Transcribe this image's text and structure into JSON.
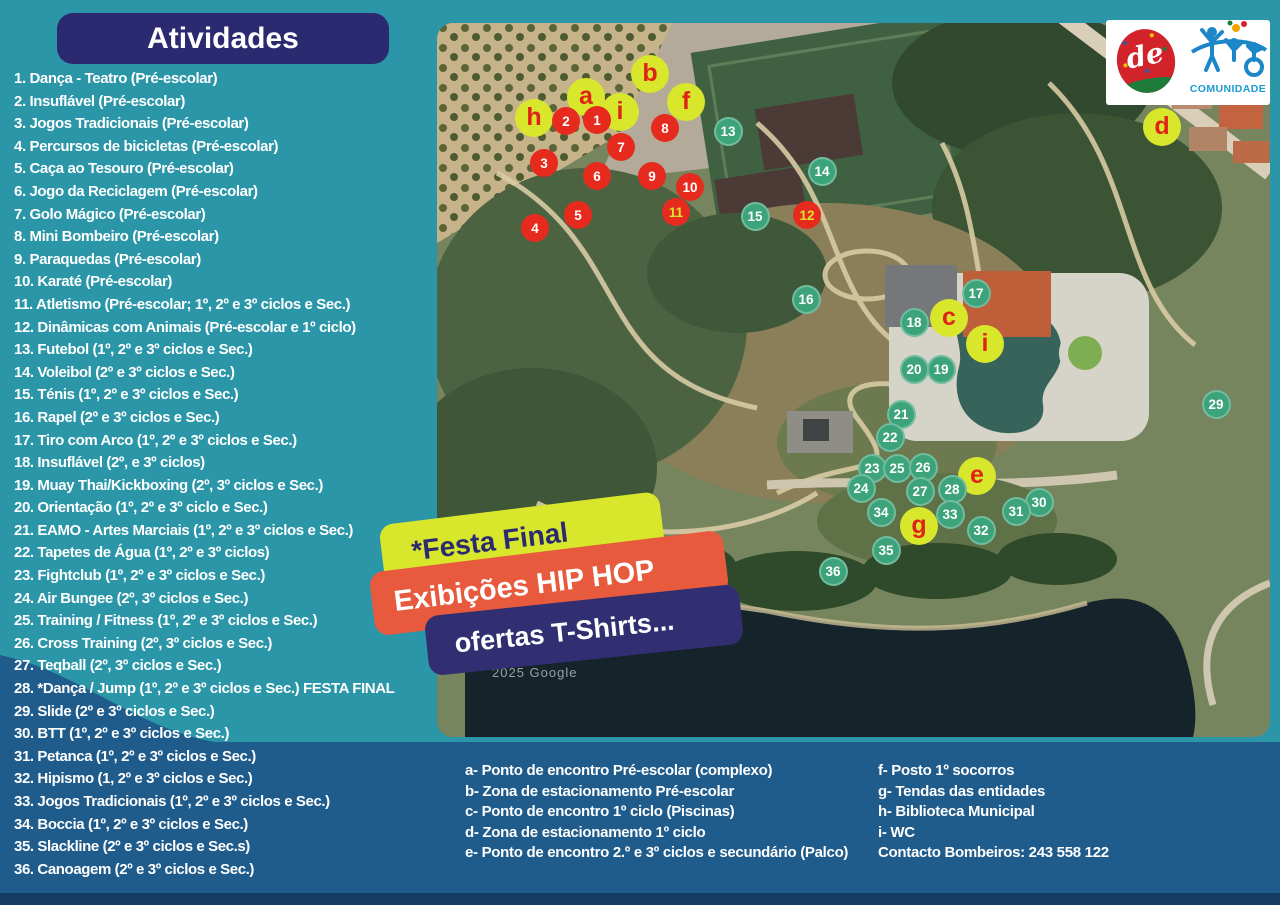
{
  "colors": {
    "bg_teal": "#2a96a8",
    "bg_wave_blue": "#1f5c8c",
    "bottom_bar": "#143c62",
    "header_navy": "#2b2a70",
    "banner_chartreuse": "#d8e72b",
    "banner_orange": "#e75a3e",
    "banner_navy": "#312f72",
    "marker_red": "#e62b1e",
    "marker_teal_green": "#3ca37b",
    "marker_letter_bg": "#d8e72b",
    "marker_letter_text": "#e02317"
  },
  "header": {
    "title": "Atividades"
  },
  "activities": [
    "1. Dança - Teatro (Pré-escolar)",
    "2. Insuflável (Pré-escolar)",
    "3. Jogos Tradicionais (Pré-escolar)",
    "4. Percursos de bicicletas (Pré-escolar)",
    "5. Caça ao Tesouro (Pré-escolar)",
    "6. Jogo da Reciclagem (Pré-escolar)",
    "7. Golo Mágico (Pré-escolar)",
    "8. Mini Bombeiro (Pré-escolar)",
    "9. Paraquedas (Pré-escolar)",
    "10. Karaté (Pré-escolar)",
    "11. Atletismo (Pré-escolar; 1º, 2º e 3º ciclos e Sec.)",
    "12. Dinâmicas com Animais (Pré-escolar e 1º ciclo)",
    "13. Futebol (1º, 2º e 3º ciclos e Sec.)",
    "14. Voleibol (2º e 3º ciclos e Sec.)",
    "15. Ténis (1º, 2º e 3º ciclos e Sec.)",
    "16. Rapel (2º e 3º ciclos e Sec.)",
    "17. Tiro com Arco (1º, 2º e 3º ciclos e Sec.)",
    "18. Insuflável (2º, e 3º ciclos)",
    "19. Muay Thai/Kickboxing (2º, 3º ciclos e Sec.)",
    "20. Orientação (1º, 2º e 3º ciclo e Sec.)",
    "21. EAMO - Artes Marciais (1º, 2º e 3º ciclos e Sec.)",
    "22. Tapetes de Água (1º, 2º e 3º ciclos)",
    "23. Fightclub (1º, 2º e 3º ciclos e Sec.)",
    "24. Air Bungee (2º, 3º ciclos e Sec.)",
    "25. Training / Fitness (1º, 2º e 3º ciclos e Sec.)",
    "26. Cross Training (2º, 3º ciclos e Sec.)",
    "27. Teqball (2º, 3º ciclos e Sec.)",
    "28. *Dança / Jump (1º, 2º e 3º ciclos e Sec.) FESTA FINAL",
    "29. Slide (2º e 3º ciclos e Sec.)",
    "30. BTT (1º, 2º e 3º ciclos e Sec.)",
    "31. Petanca (1º, 2º e 3º ciclos e Sec.)",
    "32. Hipismo  (1, 2º e 3º ciclos e Sec.)",
    "33. Jogos Tradicionais (1º, 2º e 3º ciclos e Sec.)",
    "34. Boccia (1º, 2º e 3º ciclos e Sec.)",
    "35. Slackline (2º e 3º ciclos e Sec.s)",
    "36. Canoagem (2º e 3º ciclos e Sec.)"
  ],
  "banners": {
    "festa": "*Festa Final",
    "hiphop": "Exibições HIP HOP",
    "tshirts": "ofertas T-Shirts..."
  },
  "legend": {
    "left": [
      "a- Ponto de encontro Pré-escolar (complexo)",
      "b- Zona de estacionamento Pré-escolar",
      "c- Ponto de encontro 1º ciclo (Piscinas)",
      "d- Zona de estacionamento 1º ciclo",
      "e- Ponto de encontro 2.º e 3º ciclos e secundário (Palco)"
    ],
    "right": [
      "f- Posto 1º socorros",
      "g- Tendas das entidades",
      "h- Biblioteca Municipal",
      "i- WC"
    ],
    "contact": "Contacto Bombeiros: 243 558 122"
  },
  "map": {
    "watermark": "2025 Google",
    "letter_markers": [
      {
        "label": "h",
        "x": 534,
        "y": 118
      },
      {
        "label": "a",
        "x": 586,
        "y": 97
      },
      {
        "label": "b",
        "x": 650,
        "y": 74
      },
      {
        "label": "i",
        "x": 620,
        "y": 112
      },
      {
        "label": "f",
        "x": 686,
        "y": 102
      },
      {
        "label": "d",
        "x": 1162,
        "y": 127
      },
      {
        "label": "c",
        "x": 949,
        "y": 318
      },
      {
        "label": "i",
        "x": 985,
        "y": 344
      },
      {
        "label": "e",
        "x": 977,
        "y": 476
      },
      {
        "label": "g",
        "x": 919,
        "y": 526
      }
    ],
    "red_markers": [
      {
        "label": "1",
        "x": 597,
        "y": 120
      },
      {
        "label": "2",
        "x": 566,
        "y": 121
      },
      {
        "label": "3",
        "x": 544,
        "y": 163
      },
      {
        "label": "4",
        "x": 535,
        "y": 228
      },
      {
        "label": "5",
        "x": 578,
        "y": 215
      },
      {
        "label": "6",
        "x": 597,
        "y": 176
      },
      {
        "label": "7",
        "x": 621,
        "y": 147
      },
      {
        "label": "8",
        "x": 665,
        "y": 128
      },
      {
        "label": "9",
        "x": 652,
        "y": 176
      },
      {
        "label": "10",
        "x": 690,
        "y": 187
      },
      {
        "label": "11",
        "x": 676,
        "y": 212,
        "yellow_text": true
      },
      {
        "label": "12",
        "x": 807,
        "y": 215,
        "yellow_text": true
      }
    ],
    "teal_markers": [
      {
        "label": "13",
        "x": 728,
        "y": 131
      },
      {
        "label": "14",
        "x": 822,
        "y": 171
      },
      {
        "label": "15",
        "x": 755,
        "y": 216
      },
      {
        "label": "16",
        "x": 806,
        "y": 299
      },
      {
        "label": "17",
        "x": 976,
        "y": 293
      },
      {
        "label": "18",
        "x": 914,
        "y": 322
      },
      {
        "label": "19",
        "x": 941,
        "y": 369
      },
      {
        "label": "20",
        "x": 914,
        "y": 369
      },
      {
        "label": "21",
        "x": 901,
        "y": 414
      },
      {
        "label": "22",
        "x": 890,
        "y": 437
      },
      {
        "label": "23",
        "x": 872,
        "y": 468
      },
      {
        "label": "24",
        "x": 861,
        "y": 488
      },
      {
        "label": "25",
        "x": 897,
        "y": 468
      },
      {
        "label": "26",
        "x": 923,
        "y": 467
      },
      {
        "label": "27",
        "x": 920,
        "y": 491
      },
      {
        "label": "28",
        "x": 952,
        "y": 489
      },
      {
        "label": "29",
        "x": 1216,
        "y": 404
      },
      {
        "label": "30",
        "x": 1039,
        "y": 502
      },
      {
        "label": "31",
        "x": 1016,
        "y": 511
      },
      {
        "label": "32",
        "x": 981,
        "y": 530
      },
      {
        "label": "33",
        "x": 950,
        "y": 514
      },
      {
        "label": "34",
        "x": 881,
        "y": 512
      },
      {
        "label": "35",
        "x": 886,
        "y": 550
      },
      {
        "label": "36",
        "x": 833,
        "y": 571
      }
    ]
  },
  "logos": {
    "de_script": "de",
    "comunidade_label": "COMUNIDADE"
  }
}
